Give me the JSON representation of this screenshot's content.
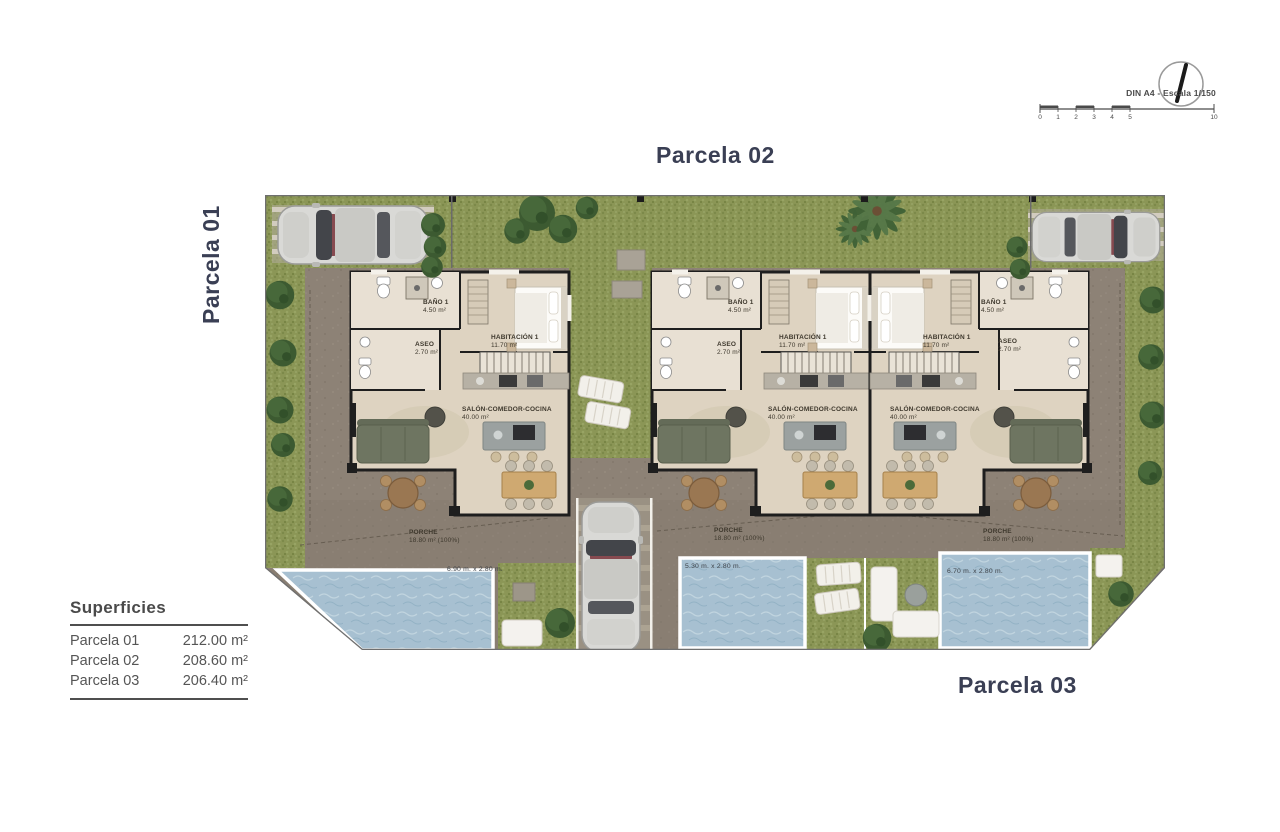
{
  "titles": {
    "parcela01": "Parcela 01",
    "parcela02": "Parcela 02",
    "parcela03": "Parcela 03"
  },
  "legend": {
    "title": "Superficies",
    "rows": [
      {
        "label": "Parcela 01",
        "value": "212.00 m²"
      },
      {
        "label": "Parcela 02",
        "value": "208.60 m²"
      },
      {
        "label": "Parcela 03",
        "value": "206.40 m²"
      }
    ]
  },
  "scalebar": {
    "caption": "DIN A4 - Escala 1/150",
    "ticks": [
      "0",
      "1",
      "2",
      "3",
      "4",
      "5",
      "10"
    ]
  },
  "villas": [
    {
      "name": "villa-parcela-01",
      "rooms": {
        "bano_label": "BAÑO 1",
        "bano_area": "4.50 m²",
        "aseo_label": "ASEO",
        "aseo_area": "2.70 m²",
        "habitacion_label": "HABITACIÓN 1",
        "habitacion_area": "11.70 m²",
        "salon_label": "SALÓN-COMEDOR-COCINA",
        "salon_area": "40.00 m²",
        "porche_label": "PORCHE",
        "porche_area": "18.80 m² (100%)"
      },
      "pool_dim": "6.90 m. x 2.80 m."
    },
    {
      "name": "villa-parcela-02",
      "rooms": {
        "bano_label": "BAÑO 1",
        "bano_area": "4.50 m²",
        "aseo_label": "ASEO",
        "aseo_area": "2.70 m²",
        "habitacion_label": "HABITACIÓN 1",
        "habitacion_area": "11.70 m²",
        "salon_label": "SALÓN-COMEDOR-COCINA",
        "salon_area": "40.00 m²",
        "porche_label": "PORCHE",
        "porche_area": "18.80 m² (100%)"
      },
      "pool_dim": "5.30 m. x 2.80 m."
    },
    {
      "name": "villa-parcela-03",
      "rooms": {
        "bano_label": "BAÑO 1",
        "bano_area": "4.50 m²",
        "aseo_label": "ASEO",
        "aseo_area": "2.70 m²",
        "habitacion_label": "HABITACIÓN 1",
        "habitacion_area": "11.70 m²",
        "salon_label": "SALÓN-COMEDOR-COCINA",
        "salon_area": "40.00 m²",
        "porche_label": "PORCHE",
        "porche_area": "18.80 m² (100%)"
      },
      "pool_dim": "6.70 m. x 2.80 m."
    }
  ],
  "colors": {
    "grass": "#8b9656",
    "paving": "#8d8276",
    "pool": "#a7c0d1",
    "wall": "#1e1e1e",
    "floor": "#ded3c1",
    "title_text": "#3a3f54",
    "legend_text": "#4d4d4d"
  }
}
